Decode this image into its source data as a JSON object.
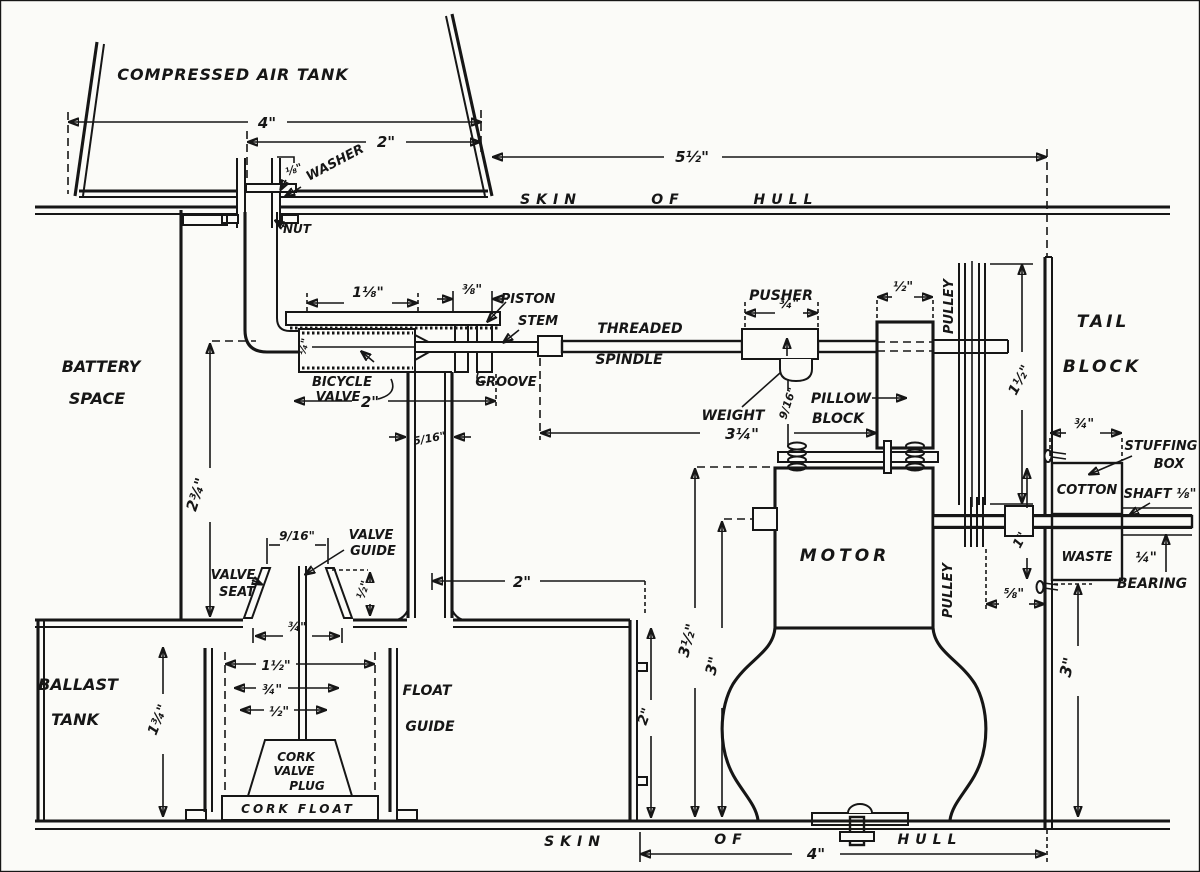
{
  "colors": {
    "paper": "#fbfbf8",
    "ink": "#161616"
  },
  "tank": {
    "label": "COMPRESSED AIR TANK",
    "width": "4\"",
    "neck": "2\"",
    "washer": "WASHER",
    "washer_thk": "⅛\"",
    "nut": "NUT"
  },
  "hull_top": {
    "skin": "SKIN",
    "of": "OF",
    "hull": "HULL",
    "length": "5½\""
  },
  "battery": {
    "l1": "BATTERY",
    "l2": "SPACE",
    "height": "2¾\""
  },
  "valve": {
    "body_w": "1⅛\"",
    "groove_w": "⅜\"",
    "piston1": "PISTON",
    "piston2": "STEM",
    "groove": "GROOVE",
    "name1": "BICYCLE",
    "name2": "VALVE",
    "base_w": "2\"",
    "bore": "¼\"",
    "tube_bore": "5/16\"",
    "tube_offset": "2\""
  },
  "spindle": {
    "l1": "THREADED",
    "l2": "SPINDLE",
    "travel": "3¼\"",
    "pusher": "PUSHER",
    "pusher_w": "¾\"",
    "weight": "WEIGHT",
    "weight_drop": "9/16\"",
    "pillow1": "PILLOW",
    "pillow2": "BLOCK",
    "pillow_w": "½\""
  },
  "drive": {
    "pulley_big": "PULLEY",
    "pulley_big_d": "1½\"",
    "pulley_small": "PULLEY",
    "coupling_h": "1\"",
    "clearance": "⅝\""
  },
  "tail": {
    "l1": "TAIL",
    "l2": "BLOCK",
    "inset": "¾\"",
    "depth": "3\""
  },
  "stuffing": {
    "l1": "STUFFING",
    "l2": "BOX",
    "cotton": "COTTON",
    "waste": "WASTE",
    "shaft": "SHAFT ⅛\"",
    "bearing_d": "¼\"",
    "bearing": "BEARING"
  },
  "motor": {
    "label": "MOTOR",
    "height": "3½\"",
    "shaft_h": "3\"",
    "base": "4\""
  },
  "seat": {
    "s1": "VALVE",
    "s2": "SEAT",
    "g1": "VALVE",
    "g2": "GUIDE",
    "mouth": "9/16\"",
    "lift": "½\"",
    "gap": "¾\"",
    "drop": "2¾\""
  },
  "ballast": {
    "l1": "BALLAST",
    "l2": "TANK",
    "depth": "1¾\"",
    "wall": "2\"",
    "fg1": "FLOAT",
    "fg2": "GUIDE",
    "float_w": "1½\"",
    "plug_w": "¾\"",
    "stem_w": "½\"",
    "plug1": "CORK",
    "plug2": "VALVE",
    "plug3": "PLUG",
    "float": "CORK FLOAT"
  },
  "hull_bottom": {
    "skin": "SKIN",
    "of": "OF",
    "hull": "HULL"
  }
}
